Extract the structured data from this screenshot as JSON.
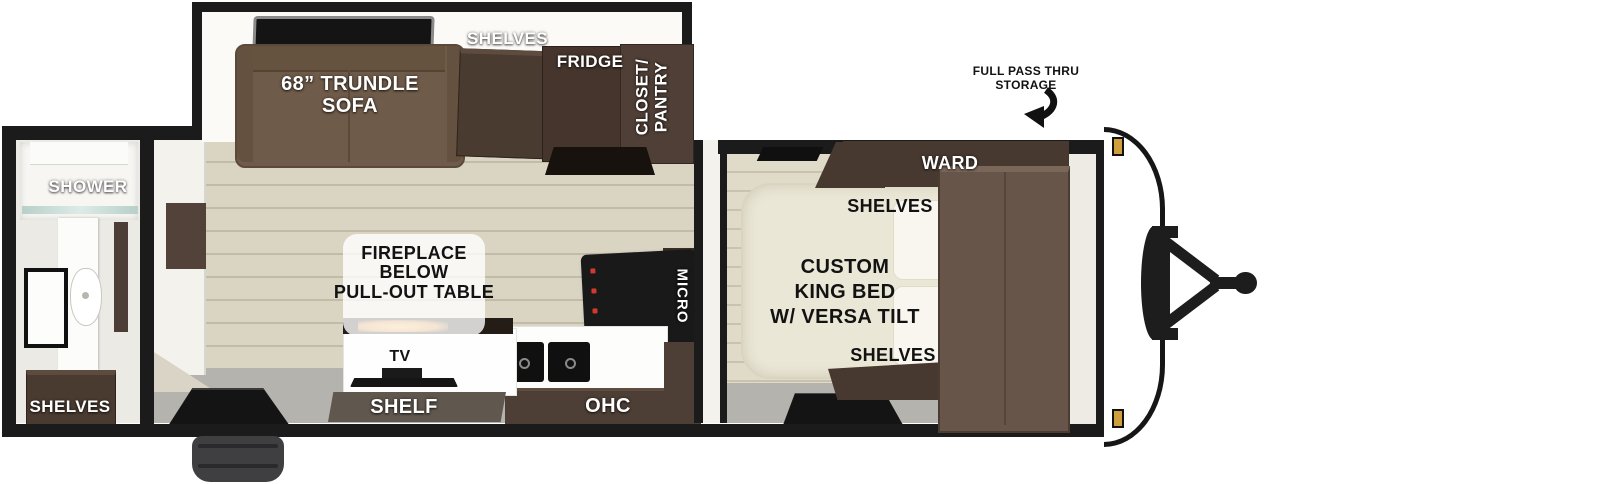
{
  "title": "Travel trailer floor plan",
  "labels": {
    "bathroom": {
      "shower": "SHOWER",
      "shelves": "SHELVES"
    },
    "living": {
      "sofa_lines": [
        "68” TRUNDLE",
        "SOFA"
      ],
      "shelves": "SHELVES",
      "fridge": "FRIDGE",
      "closet_lines": [
        "CLOSET/",
        "PANTRY"
      ],
      "fireplace_lines": [
        "FIREPLACE",
        "BELOW",
        "PULL-OUT TABLE"
      ],
      "tv": "TV",
      "shelf": "SHELF",
      "ohc": "OHC",
      "micro": "MICRO"
    },
    "bedroom": {
      "bed_lines": [
        "CUSTOM",
        "KING BED",
        "W/ VERSA TILT"
      ],
      "ward": "WARD",
      "shelves_upper": "SHELVES",
      "shelves_lower": "SHELVES"
    },
    "exterior": {
      "pass_thru_lines": [
        "FULL PASS THRU",
        "STORAGE"
      ]
    }
  },
  "colors": {
    "wall": "#1b1b1b",
    "sofa_brown": "#6f5b49",
    "cabinet_brown": "#4a3b31",
    "wardrobe_brown": "#675549",
    "bed_cream": "#ebe7d7",
    "floor_wood": "#d7d1c0",
    "floor_gray": "#b5b3ae",
    "marker_light_amber": "#cf9f3e",
    "flame_orange": "#e8a33d"
  }
}
